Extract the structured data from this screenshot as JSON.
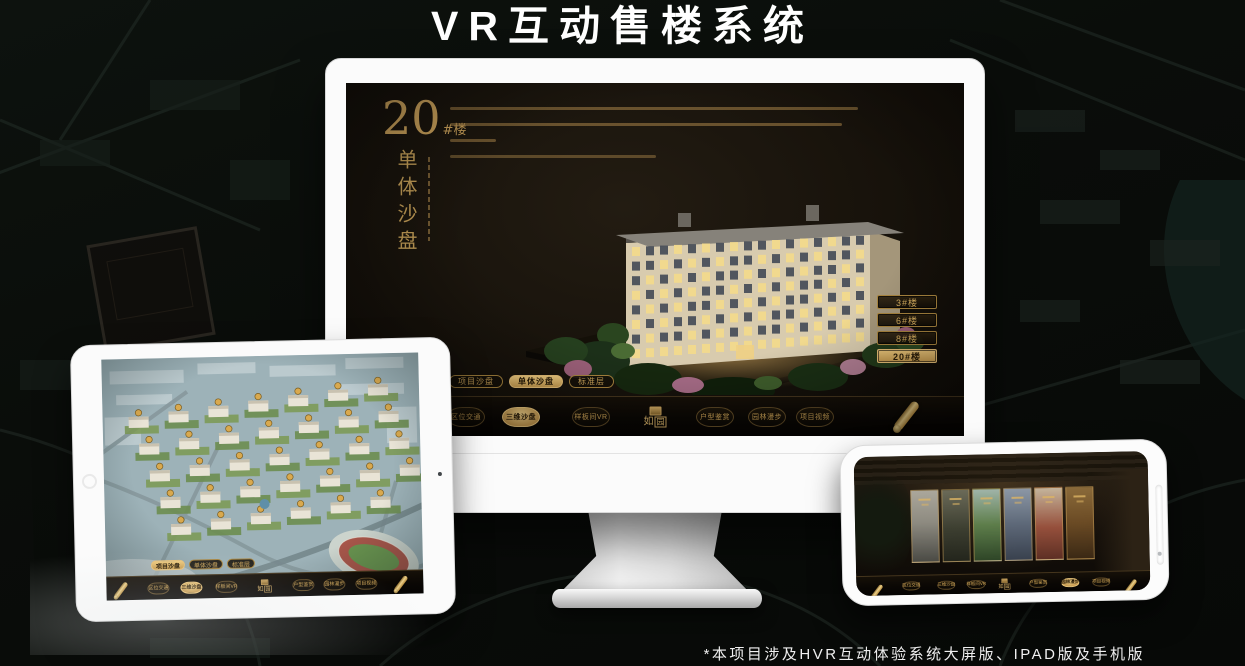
{
  "page": {
    "title": "VR互动售楼系统",
    "footnote": "*本项目涉及HVR互动体验系统大屏版、IPAD版及手机版"
  },
  "colors": {
    "gold_text": "#c9a055",
    "gold_fill": "#dcb76d",
    "screen_bg": "#17120b",
    "page_bg": "#0a0d0a"
  },
  "nav": {
    "items": [
      "区位交通",
      "三维沙盘",
      "样板间VR",
      "户型鉴赏",
      "园林漫步",
      "项目视频"
    ],
    "logo_script": "如",
    "logo_seal": "园",
    "mode_tabs": [
      "项目沙盘",
      "单体沙盘",
      "标准层"
    ]
  },
  "monitor_screen": {
    "building_no": "20",
    "building_suffix": "#楼",
    "subtitle_vertical": "单体沙盘",
    "building_buttons": [
      "3#楼",
      "6#楼",
      "8#楼",
      "20#楼"
    ],
    "active_building": "20#楼",
    "active_mode": "单体沙盘",
    "active_nav": "三维沙盘"
  },
  "tablet_screen": {
    "active_mode": "项目沙盘",
    "active_nav": "三维沙盘"
  },
  "phone_screen": {
    "active_nav": "园林漫步"
  }
}
